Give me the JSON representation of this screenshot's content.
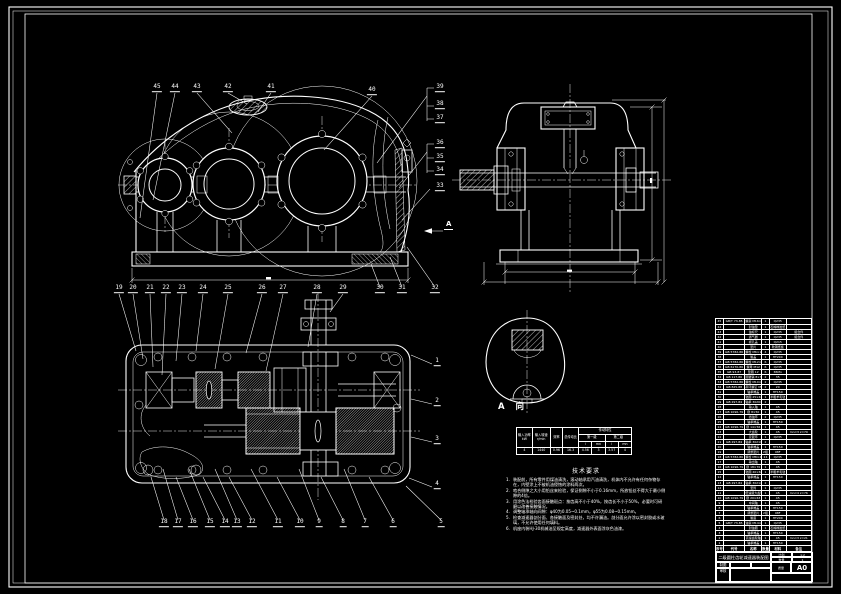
{
  "sheet": {
    "background": "#000000",
    "line_color": "#ffffff"
  },
  "labels": {
    "view_a_marker": "A",
    "view_a_title": "A 向"
  },
  "callouts": {
    "groups": [
      {
        "name": "front-top",
        "items": [
          {
            "t": "45",
            "x": 157,
            "y": 92
          },
          {
            "t": "44",
            "x": 175,
            "y": 92
          },
          {
            "t": "43",
            "x": 197,
            "y": 92
          },
          {
            "t": "42",
            "x": 228,
            "y": 92
          },
          {
            "t": "41",
            "x": 271,
            "y": 92
          },
          {
            "t": "40",
            "x": 372,
            "y": 95
          }
        ]
      },
      {
        "name": "front-right",
        "items": [
          {
            "t": "39",
            "x": 440,
            "y": 92
          },
          {
            "t": "38",
            "x": 440,
            "y": 109
          },
          {
            "t": "37",
            "x": 440,
            "y": 123
          },
          {
            "t": "36",
            "x": 440,
            "y": 148
          },
          {
            "t": "35",
            "x": 440,
            "y": 162
          },
          {
            "t": "34",
            "x": 440,
            "y": 175
          },
          {
            "t": "33",
            "x": 440,
            "y": 191
          }
        ]
      },
      {
        "name": "mid-row",
        "items": [
          {
            "t": "19",
            "x": 119,
            "y": 293
          },
          {
            "t": "20",
            "x": 133,
            "y": 293
          },
          {
            "t": "21",
            "x": 150,
            "y": 293
          },
          {
            "t": "22",
            "x": 166,
            "y": 293
          },
          {
            "t": "23",
            "x": 182,
            "y": 293
          },
          {
            "t": "24",
            "x": 203,
            "y": 293
          },
          {
            "t": "25",
            "x": 228,
            "y": 293
          },
          {
            "t": "26",
            "x": 262,
            "y": 293
          },
          {
            "t": "27",
            "x": 283,
            "y": 293
          },
          {
            "t": "28",
            "x": 317,
            "y": 293
          },
          {
            "t": "29",
            "x": 343,
            "y": 293
          },
          {
            "t": "30",
            "x": 380,
            "y": 293
          },
          {
            "t": "31",
            "x": 402,
            "y": 293
          },
          {
            "t": "32",
            "x": 435,
            "y": 293
          }
        ]
      },
      {
        "name": "plan-right",
        "items": [
          {
            "t": "1",
            "x": 437,
            "y": 366
          },
          {
            "t": "2",
            "x": 437,
            "y": 406
          },
          {
            "t": "3",
            "x": 437,
            "y": 444
          },
          {
            "t": "4",
            "x": 437,
            "y": 489
          }
        ]
      },
      {
        "name": "plan-bottom",
        "items": [
          {
            "t": "18",
            "x": 164,
            "y": 527
          },
          {
            "t": "17",
            "x": 178,
            "y": 527
          },
          {
            "t": "16",
            "x": 193,
            "y": 527
          },
          {
            "t": "15",
            "x": 210,
            "y": 527
          },
          {
            "t": "14",
            "x": 225,
            "y": 527
          },
          {
            "t": "13",
            "x": 237,
            "y": 527
          },
          {
            "t": "12",
            "x": 252,
            "y": 527
          },
          {
            "t": "11",
            "x": 278,
            "y": 527
          },
          {
            "t": "10",
            "x": 300,
            "y": 527
          },
          {
            "t": "9",
            "x": 319,
            "y": 527
          },
          {
            "t": "8",
            "x": 343,
            "y": 527
          },
          {
            "t": "7",
            "x": 365,
            "y": 527
          },
          {
            "t": "6",
            "x": 393,
            "y": 527
          },
          {
            "t": "5",
            "x": 441,
            "y": 527
          }
        ]
      }
    ]
  },
  "spec": {
    "p_label": "输入功率\nkW",
    "p_value": "4",
    "n_label": "输入转速\nr/min",
    "n_value": "1440",
    "e_label": "效率",
    "e_value": "0.96",
    "r_label": "总传动比",
    "r_value": "16.3",
    "t_label": "传动特性",
    "s1": "第一级",
    "s2": "第二级",
    "h1": "i",
    "h2": "mn",
    "h3": "i",
    "h4": "mn",
    "v1": "4.56",
    "v2": "3",
    "v3": "3.57",
    "v4": "4"
  },
  "notes": {
    "title": "技术要求",
    "items": [
      "装配前，所有零件用煤油清洗，滚动轴承用汽油清洗，机体内不允许有任何杂物存在，内壁涂上不被机油侵蚀的涂料两次。",
      "啮合侧隙之大小用铅丝来检验，保证侧隙不小于0.16mm，所放铅丝不得大于最小侧隙的4倍。",
      "用涂色法检验齿面接触斑点：按齿高不小于40%，按齿长不小于50%，必要时可研磨以改善接触情况。",
      "调整轴承轴向间隙：φ40为0.05~0.1mm，φ55为0.08~0.15mm。",
      "检查减速器剖分面、各接触面及密封处，均不许漏油。剖分面允许涂以密封胶或水玻璃，不允许使用任何填料。",
      "机座内装HJ-30机械油至规定高度，减速器外表面涂灰色油漆。"
    ]
  },
  "bom": {
    "headers": [
      "序号",
      "代号",
      "名称",
      "数量",
      "材料",
      "备注"
    ],
    "rows": [
      [
        "45",
        "GB/T 73-85",
        "螺塞 M16×1.5",
        "1",
        "Q235",
        ""
      ],
      [
        "44",
        "",
        "封油垫",
        "1",
        "石棉橡胶纸",
        ""
      ],
      [
        "43",
        "",
        "油标尺",
        "1",
        "Q235",
        "组合件"
      ],
      [
        "42",
        "",
        "通气器",
        "1",
        "Q235",
        "组合件"
      ],
      [
        "41",
        "",
        "视孔盖",
        "1",
        "Q215",
        ""
      ],
      [
        "40",
        "",
        "垫片",
        "1",
        "软钢纸板",
        ""
      ],
      [
        "39",
        "GB 5782-86",
        "螺栓 M6×16",
        "4",
        "Q235",
        ""
      ],
      [
        "38",
        "",
        "箱盖",
        "1",
        "HT200",
        ""
      ],
      [
        "37",
        "GB 5782-86",
        "螺栓 M12×100",
        "6",
        "Q235",
        ""
      ],
      [
        "36",
        "GB 6170-86",
        "螺母 M12",
        "6",
        "Q235",
        ""
      ],
      [
        "35",
        "GB 93-87",
        "垫圈 12",
        "6",
        "65Mn",
        ""
      ],
      [
        "34",
        "GB 117-86",
        "圆锥销 8×30",
        "2",
        "35",
        ""
      ],
      [
        "33",
        "GB 5782-86",
        "螺栓 M10×35",
        "2",
        "Q235",
        ""
      ],
      [
        "32",
        "GB 825-88",
        "吊环螺钉 M10",
        "2",
        "20",
        ""
      ],
      [
        "31",
        "",
        "轴承端盖",
        "1",
        "HT150",
        ""
      ],
      [
        "30",
        "",
        "毡圈 25×40",
        "1",
        "半粗羊毛毡",
        ""
      ],
      [
        "29",
        "GB 297-84",
        "轴承 30207",
        "2",
        "",
        ""
      ],
      [
        "28",
        "",
        "输入轴",
        "1",
        "45",
        ""
      ],
      [
        "27",
        "GB 1096-79",
        "键 8×50",
        "1",
        "45",
        ""
      ],
      [
        "26",
        "",
        "挡油环",
        "2",
        "Q235",
        ""
      ],
      [
        "25",
        "",
        "轴承端盖",
        "1",
        "HT150",
        ""
      ],
      [
        "24",
        "GB 1096-79",
        "键 14×56",
        "1",
        "45",
        ""
      ],
      [
        "23",
        "",
        "大齿轮",
        "1",
        "45",
        "mn=3 z=79"
      ],
      [
        "22",
        "",
        "定距环",
        "1",
        "Q235",
        ""
      ],
      [
        "21",
        "GB 297-84",
        "轴承 30211",
        "2",
        "",
        ""
      ],
      [
        "20",
        "",
        "轴承端盖",
        "1",
        "HT150",
        ""
      ],
      [
        "19",
        "",
        "调整垫片",
        "2组",
        "08F",
        ""
      ],
      [
        "18",
        "GB 5782-86",
        "螺栓 M8×25",
        "24",
        "Q235",
        ""
      ],
      [
        "17",
        "",
        "输出轴",
        "1",
        "45",
        ""
      ],
      [
        "16",
        "GB 1096-79",
        "键 18×70",
        "1",
        "45",
        ""
      ],
      [
        "15",
        "",
        "毡圈 40×60",
        "1",
        "半粗羊毛毡",
        ""
      ],
      [
        "14",
        "",
        "轴承端盖",
        "1",
        "HT150",
        ""
      ],
      [
        "13",
        "GB 297-84",
        "轴承 30214",
        "2",
        "",
        ""
      ],
      [
        "12",
        "",
        "套筒",
        "1",
        "Q235",
        ""
      ],
      [
        "11",
        "",
        "低速级大齿轮",
        "1",
        "45",
        "mn=4 z=76"
      ],
      [
        "10",
        "GB 1096-79",
        "键 20×63",
        "1",
        "45",
        ""
      ],
      [
        "9",
        "",
        "中间轴",
        "1",
        "45",
        ""
      ],
      [
        "8",
        "",
        "轴承端盖",
        "1",
        "HT150",
        ""
      ],
      [
        "7",
        "",
        "调整垫片",
        "2组",
        "08F",
        ""
      ],
      [
        "6",
        "",
        "箱座",
        "1",
        "HT200",
        ""
      ],
      [
        "5",
        "GB/T 73-85",
        "油塞 M14×1.5",
        "1",
        "Q235",
        ""
      ],
      [
        "4",
        "",
        "封油圈",
        "1",
        "石棉橡胶纸",
        ""
      ],
      [
        "3",
        "",
        "轴承端盖",
        "1",
        "HT150",
        ""
      ],
      [
        "2",
        "",
        "高速齿轮轴",
        "1",
        "45",
        "mn=3 z=21"
      ],
      [
        "1",
        "",
        "轴承端盖",
        "1",
        "HT150",
        ""
      ]
    ]
  },
  "title_block": {
    "title": "二级圆柱齿轮减速器装配图",
    "scale_label": "比例",
    "scale": "1:2",
    "qty_label": "数量",
    "qty": "1",
    "mass_label": "质量",
    "sheet": "A0",
    "draw_label": "制图",
    "check_label": "审核",
    "org": ""
  }
}
